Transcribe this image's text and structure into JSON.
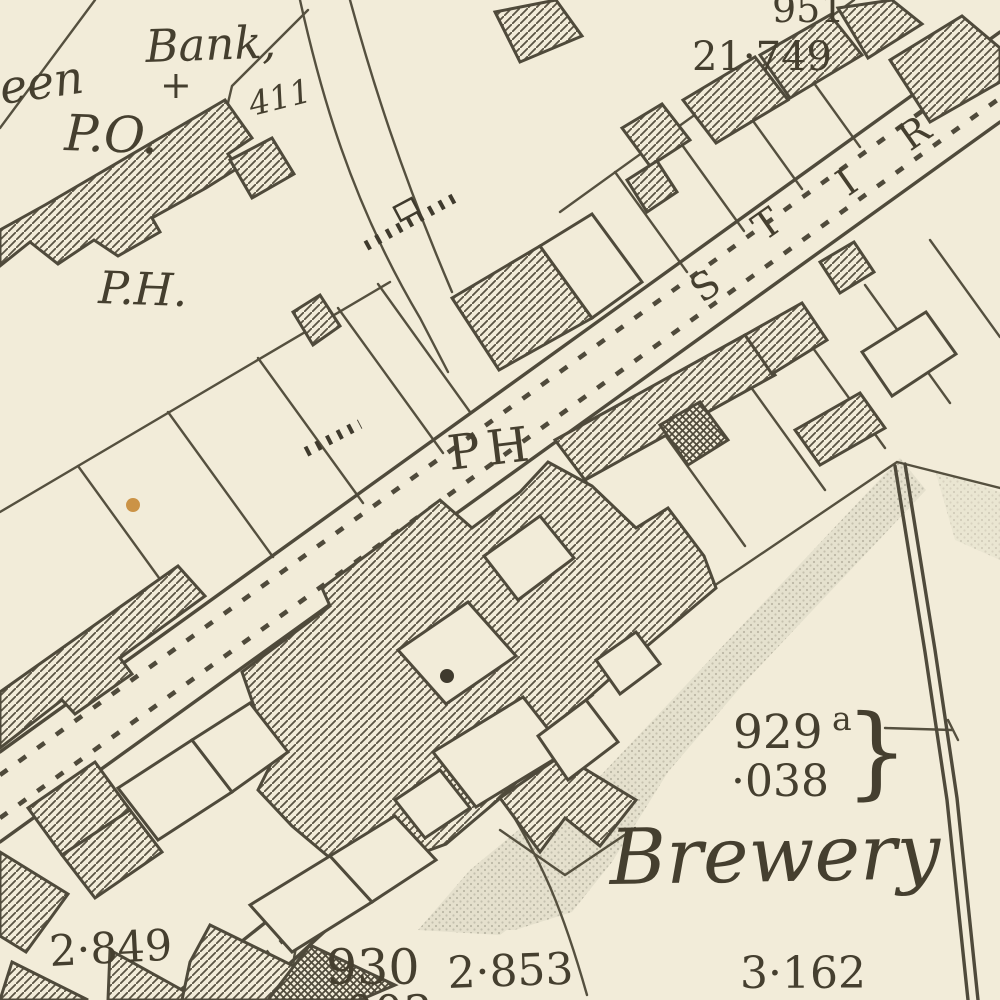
{
  "map": {
    "style": "victorian-ordnance-survey-town-plan",
    "palette": {
      "paper": "#f2ecd9",
      "ink": "#4f4a3b",
      "hatch": "#5a5444",
      "shade": "#c6c2b0",
      "stain": "#c68a35"
    },
    "street": {
      "visible_letters": [
        "S",
        "T",
        "I",
        "R"
      ]
    },
    "labels": [
      {
        "id": "partial-name-een",
        "text": "een",
        "x": 2,
        "y": 104,
        "size": 46,
        "italic": true,
        "rot": -8
      },
      {
        "id": "bank-label",
        "text": "Bank,",
        "x": 146,
        "y": 62,
        "size": 45,
        "italic": true,
        "rot": -2
      },
      {
        "id": "bank-cross-symbol",
        "text": "+",
        "x": 160,
        "y": 98,
        "size": 38,
        "italic": false,
        "rot": 0
      },
      {
        "id": "post-office-label",
        "text": "P.O.",
        "x": 64,
        "y": 150,
        "size": 50,
        "italic": true,
        "rot": 2
      },
      {
        "id": "plot-411-number",
        "text": "411",
        "x": 252,
        "y": 116,
        "size": 33,
        "italic": true,
        "rot": -14
      },
      {
        "id": "public-house-label-nw",
        "text": "P.H.",
        "x": 98,
        "y": 303,
        "size": 45,
        "italic": true,
        "rot": 2
      },
      {
        "id": "spot-level-951",
        "text": "951",
        "x": 772,
        "y": 22,
        "size": 38,
        "italic": false,
        "rot": 0
      },
      {
        "id": "spot-level-21-749",
        "text": "21·749",
        "x": 692,
        "y": 70,
        "size": 40,
        "italic": false,
        "rot": 0
      },
      {
        "id": "street-letter-s",
        "text": "S",
        "x": 702,
        "y": 304,
        "size": 38,
        "italic": false,
        "rot": -35
      },
      {
        "id": "street-letter-t",
        "text": "T",
        "x": 764,
        "y": 242,
        "size": 38,
        "italic": false,
        "rot": -35
      },
      {
        "id": "street-letter-i",
        "text": "I",
        "x": 848,
        "y": 197,
        "size": 38,
        "italic": false,
        "rot": -35
      },
      {
        "id": "street-letter-r",
        "text": "R",
        "x": 910,
        "y": 152,
        "size": 38,
        "italic": false,
        "rot": -35
      },
      {
        "id": "public-house-label-road",
        "text": "PH",
        "x": 450,
        "y": 470,
        "size": 48,
        "italic": false,
        "rot": -7,
        "spacing": 7
      },
      {
        "id": "plot-929a-number",
        "text": "929",
        "x": 733,
        "y": 748,
        "size": 47,
        "italic": false,
        "rot": 0
      },
      {
        "id": "plot-929a-suffix",
        "text": "a",
        "x": 832,
        "y": 730,
        "size": 33,
        "italic": false,
        "rot": 0
      },
      {
        "id": "plot-929a-area",
        "text": "·038",
        "x": 731,
        "y": 796,
        "size": 44,
        "italic": false,
        "rot": 0
      },
      {
        "id": "plot-929a-brace",
        "text": "}",
        "x": 845,
        "y": 786,
        "size": 100,
        "italic": false,
        "rot": 0
      },
      {
        "id": "brewery-label",
        "text": "Brewery",
        "x": 610,
        "y": 884,
        "size": 77,
        "italic": true,
        "rot": -1
      },
      {
        "id": "area-2-849",
        "text": "2·849",
        "x": 50,
        "y": 966,
        "size": 43,
        "italic": false,
        "rot": -3
      },
      {
        "id": "plot-930-number",
        "text": "930",
        "x": 326,
        "y": 984,
        "size": 49,
        "italic": false,
        "rot": 0
      },
      {
        "id": "plot-930-area",
        "text": "·003",
        "x": 330,
        "y": 1028,
        "size": 46,
        "italic": false,
        "rot": 0
      },
      {
        "id": "area-2-853",
        "text": "2·853",
        "x": 448,
        "y": 988,
        "size": 44,
        "italic": false,
        "rot": -2
      },
      {
        "id": "area-3-162",
        "text": "3·162",
        "x": 740,
        "y": 988,
        "size": 44,
        "italic": false,
        "rot": 0
      }
    ]
  }
}
